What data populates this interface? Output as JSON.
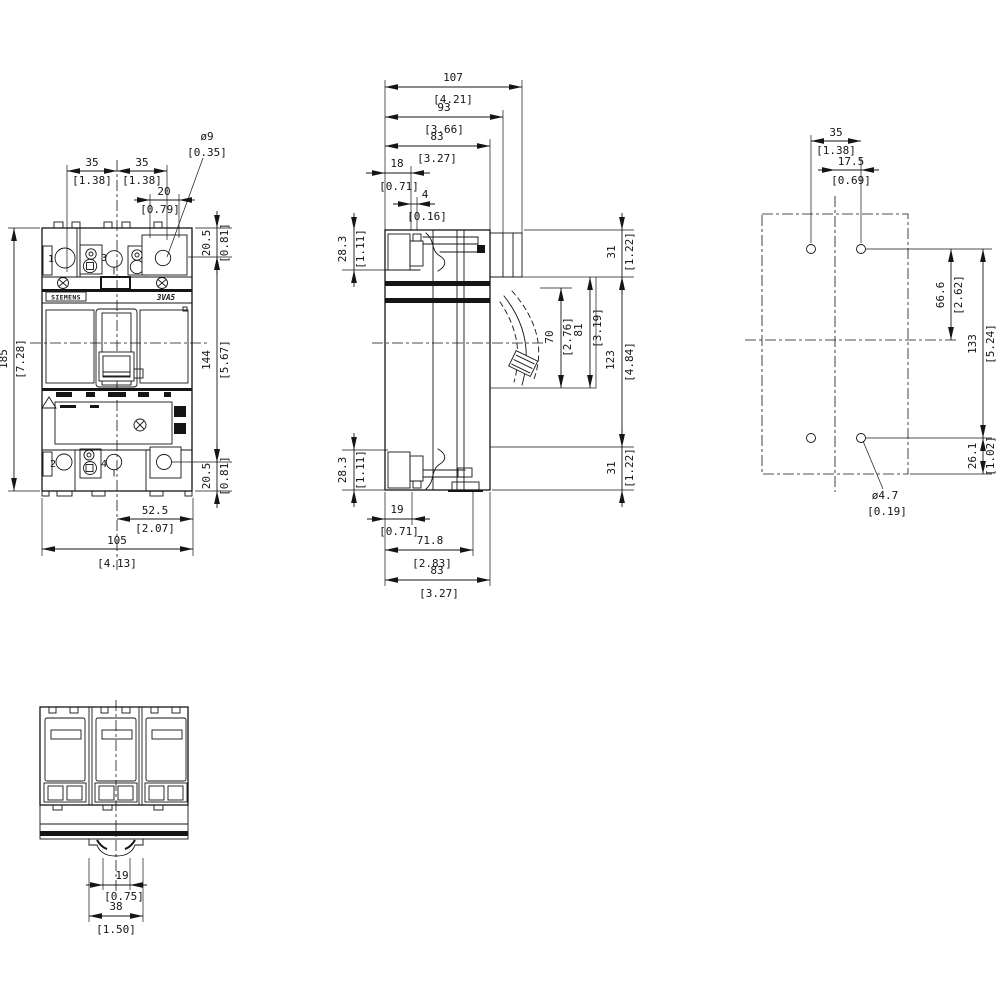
{
  "drawing": {
    "brand": "SIEMENS",
    "model": "3VA5",
    "views": {
      "front": {
        "terminal_labels": {
          "t1": "1",
          "t2": "2",
          "t3": "3",
          "t4": "4"
        },
        "dims": {
          "pitch_a": {
            "mm": "35",
            "inch": "[1.38]"
          },
          "pitch_b": {
            "mm": "35",
            "inch": "[1.38]"
          },
          "lug_width": {
            "mm": "20",
            "inch": "[0.79]"
          },
          "lug_hole": {
            "mm": "ø9",
            "inch": "[0.35]"
          },
          "height_total": {
            "mm": "185",
            "inch": "[7.28]"
          },
          "height_top_terminal": {
            "mm": "20.5",
            "inch": "[0.81]"
          },
          "height_body": {
            "mm": "144",
            "inch": "[5.67]"
          },
          "height_bottom_terminal": {
            "mm": "20.5",
            "inch": "[0.81]"
          },
          "width_half": {
            "mm": "52.5",
            "inch": "[2.07]"
          },
          "width_total": {
            "mm": "105",
            "inch": "[4.13]"
          }
        }
      },
      "side": {
        "dims": {
          "depth_107": {
            "mm": "107",
            "inch": "[4.21]"
          },
          "depth_93": {
            "mm": "93",
            "inch": "[3.66]"
          },
          "depth_83": {
            "mm": "83",
            "inch": "[3.27]"
          },
          "offset_18": {
            "mm": "18",
            "inch": "[0.71]"
          },
          "offset_4": {
            "mm": "4",
            "inch": "[0.16]"
          },
          "terminal_top": {
            "mm": "28.3",
            "inch": "[1.11]"
          },
          "terminal_bottom": {
            "mm": "28.3",
            "inch": "[1.11]"
          },
          "top_31": {
            "mm": "31",
            "inch": "[1.22]"
          },
          "handle_window_70": {
            "mm": "70",
            "inch": "[2.76]"
          },
          "handle_window_81": {
            "mm": "81",
            "inch": "[3.19]"
          },
          "mid_123": {
            "mm": "123",
            "inch": "[4.84]"
          },
          "bottom_31": {
            "mm": "31",
            "inch": "[1.22]"
          },
          "foot_19": {
            "mm": "19",
            "inch": "[0.71]"
          },
          "depth_71_8": {
            "mm": "71.8",
            "inch": "[2.83]"
          },
          "depth_bottom_83": {
            "mm": "83",
            "inch": "[3.27]"
          }
        }
      },
      "mounting": {
        "dims": {
          "hole_pitch_35": {
            "mm": "35",
            "inch": "[1.38]"
          },
          "hole_offset_175": {
            "mm": "17.5",
            "inch": "[0.69]"
          },
          "hole_center_666": {
            "mm": "66.6",
            "inch": "[2.62]"
          },
          "hole_pitch_133": {
            "mm": "133",
            "inch": "[5.24]"
          },
          "hole_edge_261": {
            "mm": "26.1",
            "inch": "[1.02]"
          },
          "hole_dia": {
            "mm": "ø4.7",
            "inch": "[0.19]"
          }
        }
      },
      "bottom": {
        "dims": {
          "rail_slot_19": {
            "mm": "19",
            "inch": "[0.75]"
          },
          "rail_foot_38": {
            "mm": "38",
            "inch": "[1.50]"
          }
        }
      }
    }
  }
}
